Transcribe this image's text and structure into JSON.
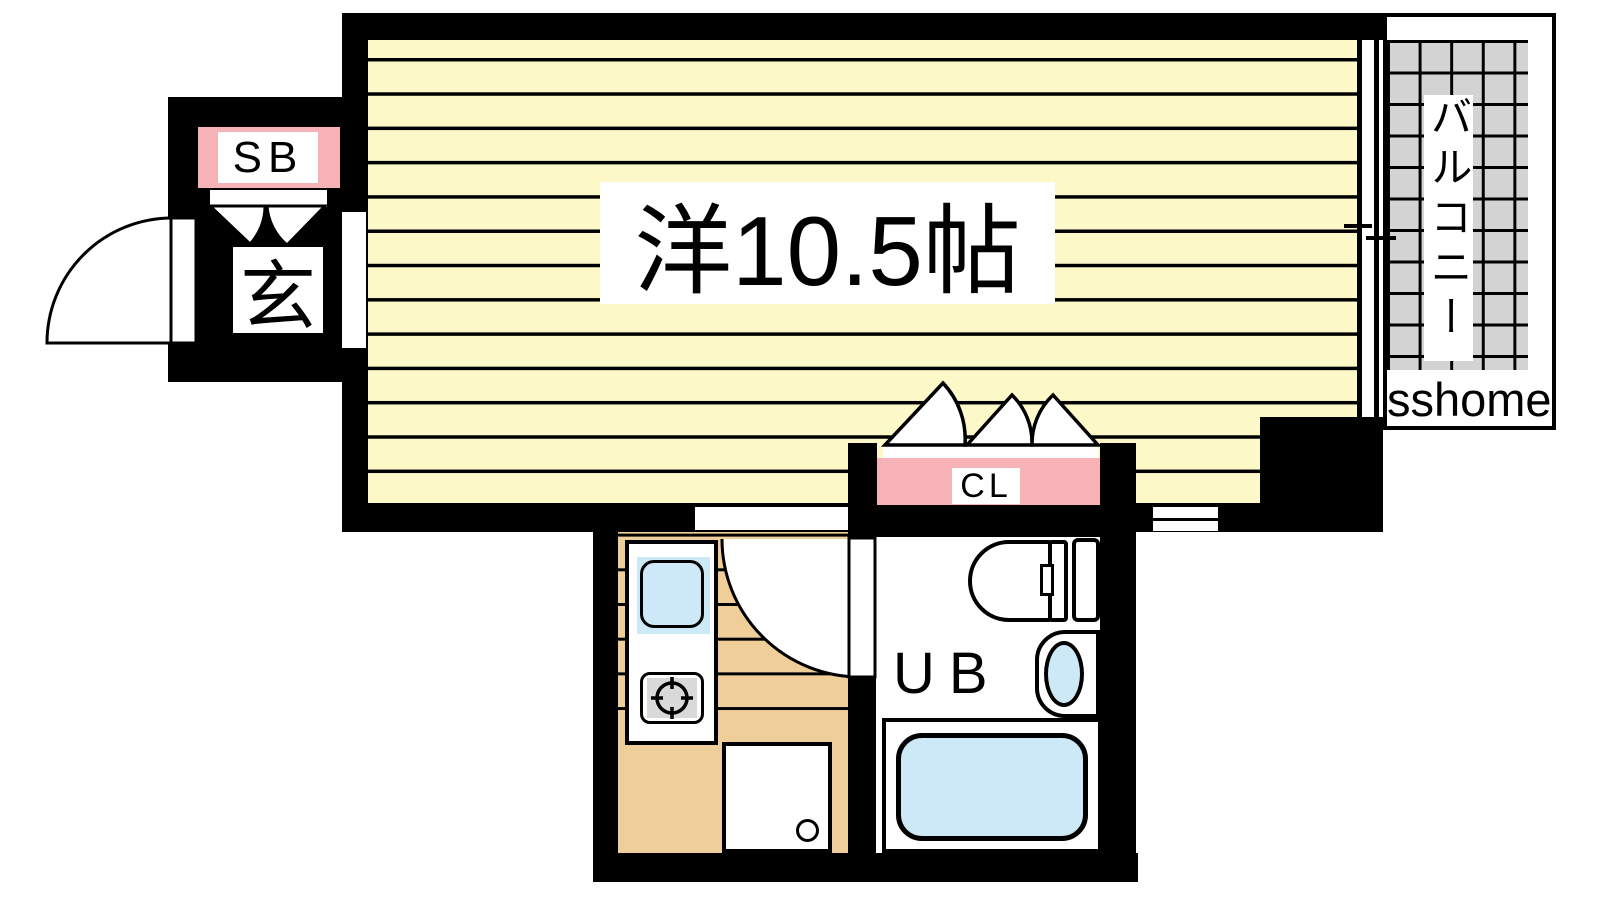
{
  "floorplan": {
    "rooms": {
      "main_room": {
        "label": "洋10.5帖"
      },
      "entrance": {
        "label": "玄",
        "shoe_box_label": "SB"
      },
      "closet": {
        "label": "CL"
      },
      "unit_bath": {
        "label": "UB"
      },
      "balcony": {
        "label": "バルコニー"
      }
    },
    "watermark": "sshome"
  },
  "colors": {
    "wall": "#000000",
    "room_fill": "#fcf8c8",
    "accent_pink": "#f7b2b7",
    "tile_gray": "#d3d3d3",
    "floor_tan": "#f0ce9a",
    "fixture_blue": "#cde9f8"
  }
}
